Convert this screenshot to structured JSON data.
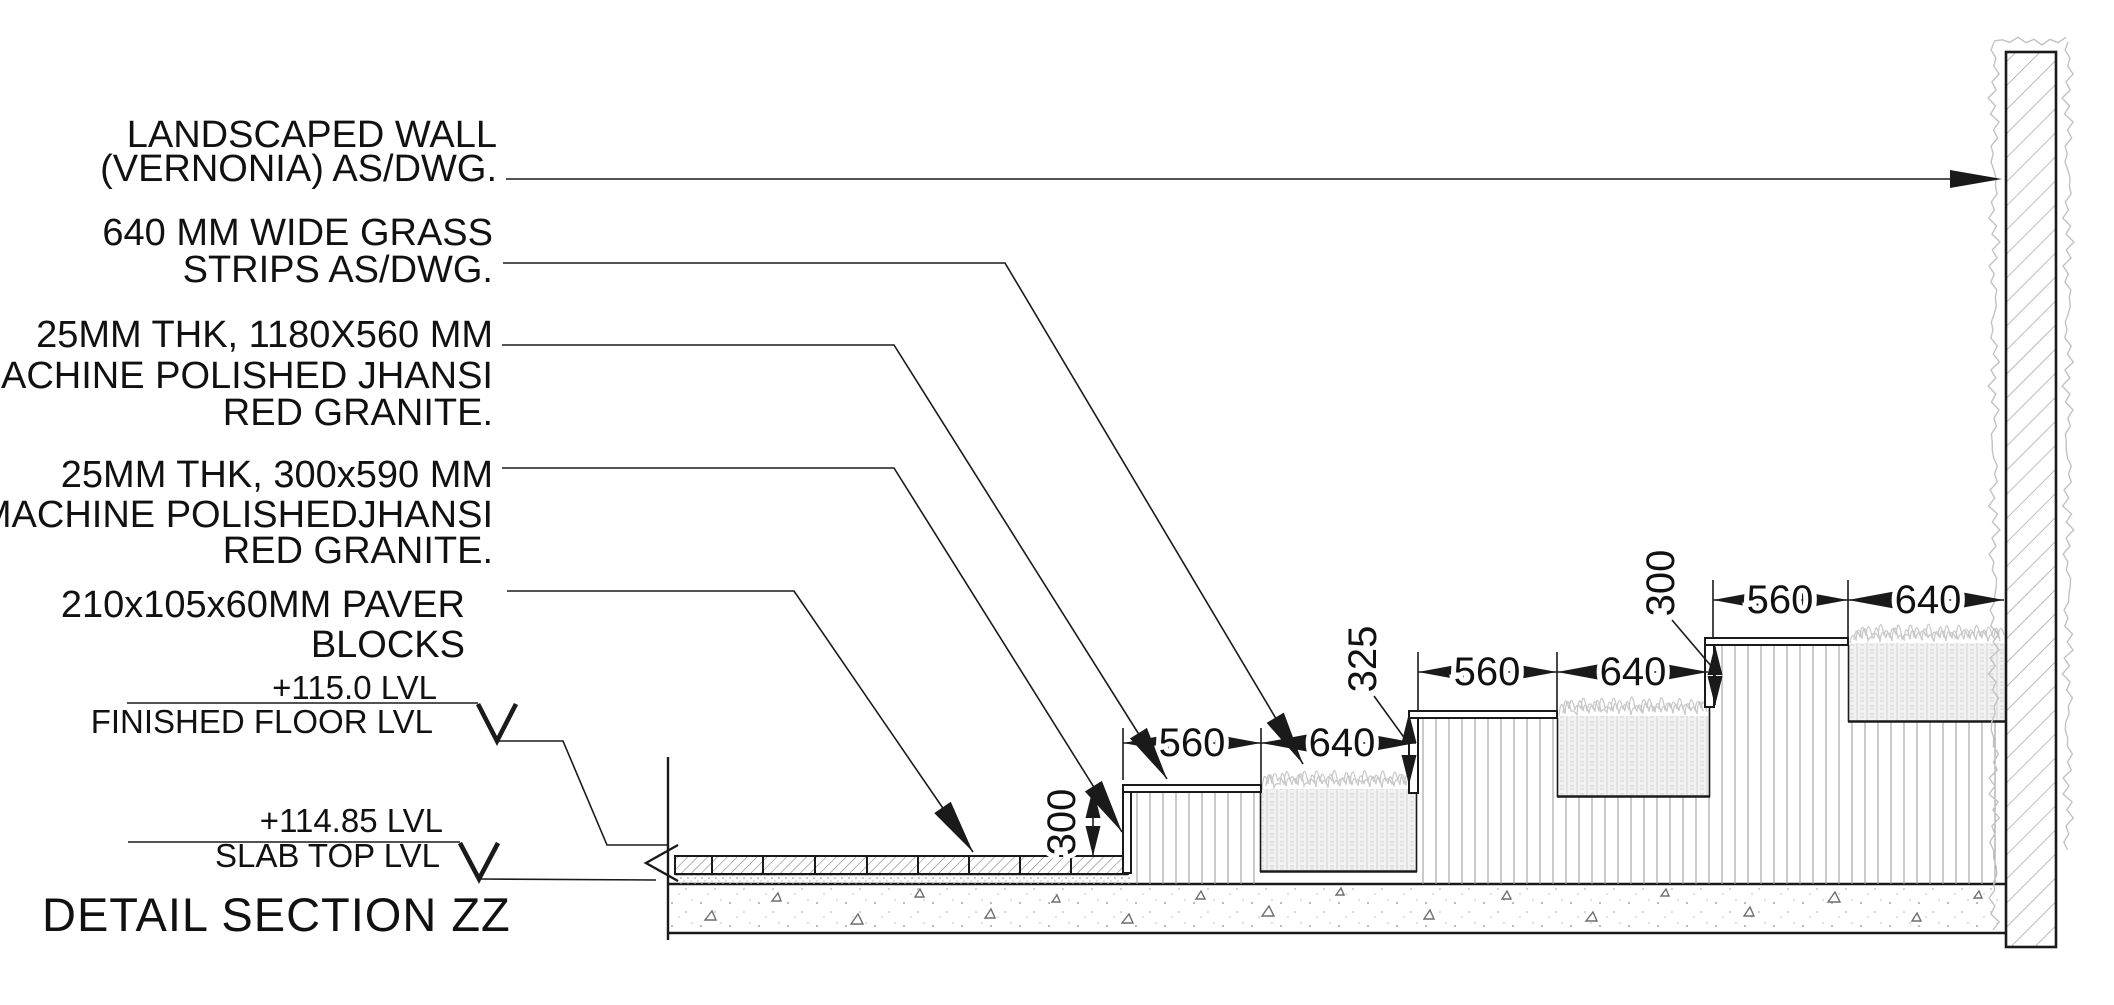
{
  "title": "DETAIL SECTION ZZ",
  "callouts": {
    "landscaped_wall": {
      "lines": [
        "LANDSCAPED WALL",
        "(VERNONIA) AS/DWG."
      ]
    },
    "grass_strips": {
      "lines": [
        "640 MM WIDE GRASS",
        "STRIPS AS/DWG."
      ]
    },
    "granite_tread": {
      "lines": [
        "25MM THK, 1180X560 MM",
        "MACHINE POLISHED JHANSI",
        "RED GRANITE."
      ]
    },
    "granite_riser": {
      "lines": [
        "25MM THK, 300x590 MM",
        "MACHINE POLISHEDJHANSI",
        "RED GRANITE."
      ]
    },
    "paver_blocks": {
      "lines": [
        "210x105x60MM PAVER",
        "BLOCKS"
      ]
    }
  },
  "levels": {
    "finished_floor": {
      "value": "+115.0 LVL",
      "label": "FINISHED FLOOR LVL"
    },
    "slab_top": {
      "value": "+114.85 LVL",
      "label": "SLAB TOP LVL"
    }
  },
  "dimensions": {
    "tier1": {
      "tread": "560",
      "grass": "640",
      "riser": "300"
    },
    "tier2": {
      "tread": "560",
      "grass": "640",
      "riser": "325"
    },
    "tier3": {
      "tread": "560",
      "grass": "640",
      "riser": "300"
    }
  },
  "colors": {
    "line": "#1a1a1a",
    "hatch": "#999999",
    "grass": "#c9c9c9",
    "background": "#ffffff"
  }
}
